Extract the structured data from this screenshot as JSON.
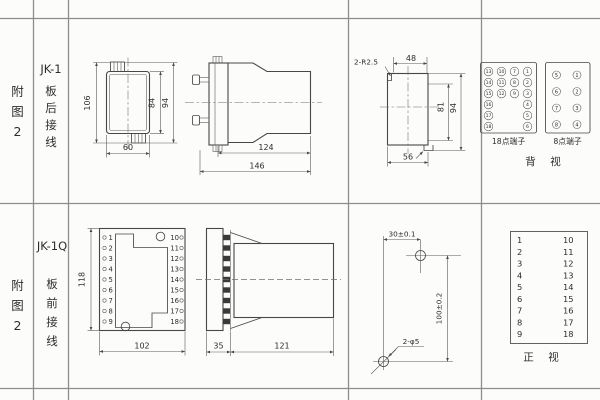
{
  "row1": {
    "col1": [
      "附",
      "图",
      "2"
    ],
    "col2": {
      "title": "JK-1",
      "sub": [
        "板",
        "后",
        "接",
        "线"
      ]
    },
    "front_view": {
      "dim_left": "106",
      "dim_inner": "84",
      "dim_outer": "94",
      "dim_width": "60"
    },
    "side_view": {
      "dim_body": "124",
      "dim_overall": "146"
    },
    "cutout": {
      "dim_radius": "2-R2.5",
      "dim_top": "48",
      "dim_inner": "81",
      "dim_outer": "94",
      "dim_width": "56"
    },
    "t18": {
      "label": "18点端子",
      "r0": [
        "13",
        "10",
        "7",
        "1"
      ],
      "r1": [
        "14",
        "11",
        "8",
        "2"
      ],
      "r2": [
        "15",
        "12",
        "9",
        "3"
      ],
      "r3": [
        "16",
        "4"
      ],
      "r4": [
        "17",
        "5"
      ],
      "r5": [
        "18",
        "6"
      ]
    },
    "t8": {
      "label": "8点端子",
      "r0": [
        "5",
        "1"
      ],
      "r1": [
        "6",
        "2"
      ],
      "r2": [
        "7",
        "3"
      ],
      "r3": [
        "8",
        "4"
      ]
    },
    "caption": "背　视"
  },
  "row2": {
    "col1": [
      "附",
      "图",
      "2"
    ],
    "col2": {
      "title": "JK-1Q",
      "sub": [
        "板",
        "前",
        "接",
        "线"
      ]
    },
    "plate": {
      "left": [
        "1",
        "2",
        "3",
        "4",
        "5",
        "6",
        "7",
        "8",
        "9"
      ],
      "right": [
        "10",
        "11",
        "12",
        "13",
        "14",
        "15",
        "16",
        "17",
        "18"
      ],
      "dim_height": "118",
      "dim_width": "102"
    },
    "side_view": {
      "dim_flange": "35",
      "dim_body": "121"
    },
    "drill": {
      "dim_horizontal": "30±0.1",
      "dim_vertical": "100±0.2",
      "dim_holes": "2-φ5"
    },
    "front_table": {
      "left": [
        "1",
        "2",
        "3",
        "4",
        "5",
        "6",
        "7",
        "8",
        "9"
      ],
      "right": [
        "10",
        "11",
        "12",
        "13",
        "14",
        "15",
        "16",
        "17",
        "18"
      ],
      "caption": "正　视"
    }
  }
}
